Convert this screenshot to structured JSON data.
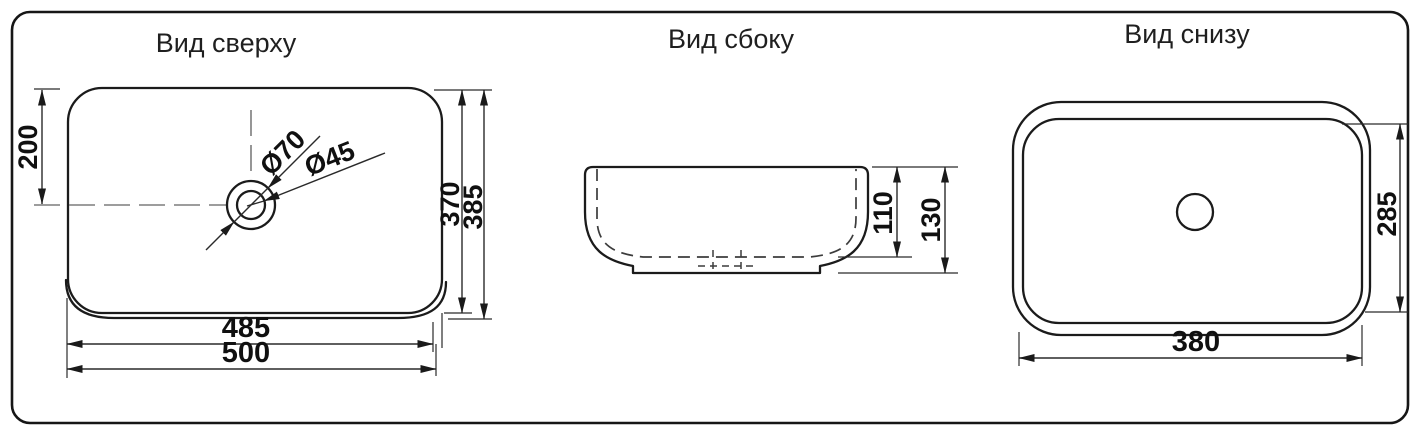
{
  "page": {
    "background": "#ffffff",
    "line_color": "#1b1b1b"
  },
  "views": {
    "top": {
      "title": "Вид сверху",
      "dim_drain_offset_y": "200",
      "dim_bowl_length": "370",
      "dim_total_length": "385",
      "dim_bowl_width": "485",
      "dim_total_width": "500",
      "dim_drain_outer_diameter": "Ø70",
      "dim_drain_hole_diameter": "Ø45"
    },
    "side": {
      "title": "Вид сбоку",
      "dim_bowl_depth": "110",
      "dim_total_height": "130"
    },
    "bottom": {
      "title": "Вид снизу",
      "dim_base_width": "380",
      "dim_base_depth": "285"
    }
  }
}
